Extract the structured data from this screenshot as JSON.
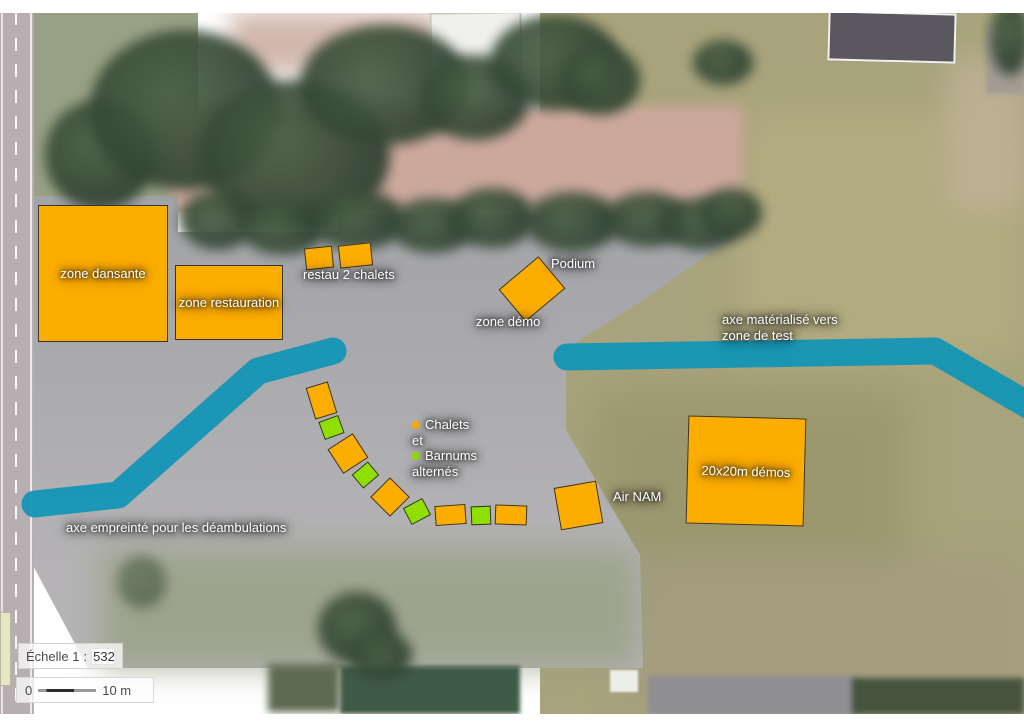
{
  "colors": {
    "chalet_orange": "#FBAD00",
    "barnum_green": "#8FE000",
    "axis_teal": "#1095B6",
    "shape_border": "#38342b"
  },
  "background": {
    "features": [
      {
        "name": "grass-field-right",
        "x": 540,
        "y": 10,
        "w": 484,
        "h": 708,
        "bg": "#a8a37c"
      },
      {
        "name": "grass-field-patch-light",
        "x": 740,
        "y": 110,
        "w": 284,
        "h": 250,
        "bg": "#b4ac82",
        "blur": 18,
        "opacity": 0.9
      },
      {
        "name": "grass-field-patch-dark",
        "x": 590,
        "y": 390,
        "w": 320,
        "h": 200,
        "bg": "#98956c",
        "blur": 22,
        "opacity": 0.8
      },
      {
        "name": "grass-field-patch-brown",
        "x": 620,
        "y": 556,
        "w": 404,
        "h": 150,
        "bg": "#a59c7e",
        "blur": 18,
        "opacity": 0.9
      },
      {
        "name": "grass-field-pink-edge",
        "x": 948,
        "y": 58,
        "w": 76,
        "h": 150,
        "bg": "#c0b298",
        "blur": 14,
        "opacity": 0.8
      },
      {
        "name": "grass-strip-left",
        "x": 28,
        "y": 12,
        "w": 170,
        "h": 200,
        "bg": "#98a185"
      },
      {
        "name": "dirt-strip-top",
        "x": 168,
        "y": 106,
        "w": 574,
        "h": 110,
        "bg": "#cca89c",
        "blur": 6
      },
      {
        "name": "dirt-patch-topcenter",
        "x": 230,
        "y": 12,
        "w": 210,
        "h": 62,
        "bg": "#c9ab9e",
        "blur": 12,
        "opacity": 0.85
      },
      {
        "name": "asphalt-lot",
        "x": 0,
        "y": 0,
        "w": 1024,
        "h": 728,
        "bg": "linear-gradient(180deg,#9b9da1 0%,#a8a8ac 45%,#b5b3b5 78%)",
        "clip": "polygon(30px 196px,178px 196px,178px 232px,338px 232px,338px 214px,726px 214px,726px 242px,643px 300px,574px 344px,566px 360px,566px 430px,640px 555px,643px 668px,88px 668px,30px 560px)"
      },
      {
        "name": "grass-regrowth-lot",
        "x": 100,
        "y": 548,
        "w": 540,
        "h": 120,
        "bg": "#98a083",
        "blur": 16,
        "opacity": 0.8
      },
      {
        "name": "road-left",
        "x": 0,
        "y": 12,
        "w": 34,
        "h": 704,
        "bg": "#b6aeb0"
      },
      {
        "name": "road-line-left-edge",
        "x": 1,
        "y": 12,
        "w": 2,
        "h": 704,
        "bg": "#f4f2f0",
        "opacity": 0.8
      },
      {
        "name": "road-line-center-dashed",
        "x": 15,
        "y": 12,
        "w": 2,
        "h": 704,
        "bg": "repeating-linear-gradient(180deg,#ffffff 0 13px,rgba(255,255,255,0) 13px 26px)",
        "opacity": 0.9
      },
      {
        "name": "road-line-right-edge",
        "x": 30,
        "y": 12,
        "w": 2,
        "h": 704,
        "bg": "#f4f2f0",
        "opacity": 0.85
      },
      {
        "name": "inset-map-sliver",
        "x": 0,
        "y": 612,
        "w": 9,
        "h": 72,
        "bg": "#e4e6c4",
        "border": "1px solid #b8b89a"
      },
      {
        "name": "building-white-roof",
        "x": 430,
        "y": 12,
        "w": 88,
        "h": 64,
        "bg": "#f0f0ec",
        "border": "2px solid #c9c9c2",
        "rot": -1
      },
      {
        "name": "building-dark-roof",
        "x": 828,
        "y": 12,
        "w": 124,
        "h": 46,
        "bg": "#5a575e",
        "border": "2px solid #f2f2ef",
        "rot": 1.5
      },
      {
        "name": "structure-right-edge",
        "x": 986,
        "y": 24,
        "w": 38,
        "h": 70,
        "bg": "#a49c93",
        "blur": 2
      },
      {
        "name": "greenhouse-bottom",
        "x": 340,
        "y": 666,
        "w": 180,
        "h": 48,
        "bg": "#3f5a46",
        "blur": 2
      },
      {
        "name": "hedge-bottom-left",
        "x": 268,
        "y": 664,
        "w": 72,
        "h": 48,
        "bg": "#5d6b52",
        "blur": 4
      },
      {
        "name": "white-shed-bottom",
        "x": 610,
        "y": 670,
        "w": 28,
        "h": 22,
        "bg": "#eceeea",
        "blur": 1
      },
      {
        "name": "shed-row-bottom",
        "x": 648,
        "y": 676,
        "w": 210,
        "h": 38,
        "bg": "#8f8e92",
        "blur": 2
      },
      {
        "name": "hedge-bottom-right",
        "x": 852,
        "y": 678,
        "w": 172,
        "h": 36,
        "bg": "#46543f",
        "blur": 3
      },
      {
        "name": "tree-canopy",
        "x": 45,
        "y": 100,
        "w": 110,
        "h": 110,
        "tree": true
      },
      {
        "name": "tree-canopy",
        "x": 90,
        "y": 30,
        "w": 190,
        "h": 160,
        "tree": true
      },
      {
        "name": "tree-canopy",
        "x": 200,
        "y": 80,
        "w": 190,
        "h": 150,
        "tree": true
      },
      {
        "name": "tree-canopy",
        "x": 300,
        "y": 25,
        "w": 170,
        "h": 120,
        "tree": true
      },
      {
        "name": "tree-canopy",
        "x": 420,
        "y": 55,
        "w": 110,
        "h": 85,
        "tree": true
      },
      {
        "name": "tree-canopy",
        "x": 490,
        "y": 15,
        "w": 130,
        "h": 95,
        "tree": true
      },
      {
        "name": "tree-canopy",
        "x": 560,
        "y": 45,
        "w": 80,
        "h": 70,
        "tree": true
      },
      {
        "name": "tree-canopy",
        "x": 180,
        "y": 190,
        "w": 75,
        "h": 60,
        "tree": true
      },
      {
        "name": "tree-canopy",
        "x": 240,
        "y": 200,
        "w": 85,
        "h": 55,
        "tree": true
      },
      {
        "name": "tree-canopy",
        "x": 310,
        "y": 190,
        "w": 95,
        "h": 60,
        "tree": true
      },
      {
        "name": "tree-canopy",
        "x": 390,
        "y": 198,
        "w": 85,
        "h": 55,
        "tree": true
      },
      {
        "name": "tree-canopy",
        "x": 450,
        "y": 188,
        "w": 85,
        "h": 60,
        "tree": true
      },
      {
        "name": "tree-canopy",
        "x": 525,
        "y": 192,
        "w": 95,
        "h": 60,
        "tree": true
      },
      {
        "name": "tree-canopy",
        "x": 605,
        "y": 192,
        "w": 85,
        "h": 55,
        "tree": true
      },
      {
        "name": "tree-canopy",
        "x": 662,
        "y": 198,
        "w": 78,
        "h": 52,
        "tree": true
      },
      {
        "name": "tree-canopy",
        "x": 700,
        "y": 188,
        "w": 62,
        "h": 50,
        "tree": true
      },
      {
        "name": "tree-canopy",
        "x": 693,
        "y": 40,
        "w": 60,
        "h": 45,
        "tree": true
      },
      {
        "name": "tree-canopy",
        "x": 990,
        "y": 0,
        "w": 40,
        "h": 75,
        "tree": true
      },
      {
        "name": "tree-canopy",
        "x": 318,
        "y": 592,
        "w": 78,
        "h": 72,
        "tree": true
      },
      {
        "name": "tree-canopy",
        "x": 350,
        "y": 630,
        "w": 62,
        "h": 50,
        "tree": true
      },
      {
        "name": "tree-canopy",
        "x": 118,
        "y": 556,
        "w": 48,
        "h": 52,
        "tree": true,
        "opacity": 0.55
      },
      {
        "name": "margin-top-white",
        "x": 0,
        "y": 0,
        "w": 1024,
        "h": 13,
        "bg": "#ffffff"
      },
      {
        "name": "margin-bottom-white",
        "x": 0,
        "y": 714,
        "w": 1024,
        "h": 14,
        "bg": "#ffffff"
      }
    ]
  },
  "paths": [
    {
      "name": "axe-deambulations-path",
      "points": "35,504 118,495 258,371 333,351"
    },
    {
      "name": "axe-zone-test-path",
      "points": "567,357 935,351 1040,412"
    }
  ],
  "zones": [
    {
      "name": "zone-dansante",
      "label": "zone dansante",
      "x": 38,
      "y": 205,
      "w": 130,
      "h": 137,
      "rot": 0
    },
    {
      "name": "zone-restauration",
      "label": "zone restauration",
      "x": 175,
      "y": 265,
      "w": 108,
      "h": 75,
      "rot": 0
    },
    {
      "name": "restau-chalet-1",
      "x": 305,
      "y": 247,
      "w": 28,
      "h": 22,
      "rot": -6
    },
    {
      "name": "restau-chalet-2",
      "x": 339,
      "y": 244,
      "w": 33,
      "h": 23,
      "rot": -6
    },
    {
      "name": "podium-stage",
      "x": 506,
      "y": 268,
      "w": 52,
      "h": 42,
      "rot": -40
    },
    {
      "name": "air-nam-square",
      "x": 557,
      "y": 484,
      "w": 43,
      "h": 43,
      "rot": -10
    },
    {
      "name": "demos-20x20-square",
      "label": "20x20m démos",
      "x": 687,
      "y": 417,
      "w": 118,
      "h": 108,
      "rot": 1.5
    }
  ],
  "arc_markers": [
    {
      "type": "chalet",
      "x": 310,
      "y": 384,
      "w": 23,
      "h": 33,
      "rot": -17
    },
    {
      "type": "barnum",
      "x": 321,
      "y": 418,
      "w": 21,
      "h": 19,
      "rot": -20
    },
    {
      "type": "chalet",
      "x": 333,
      "y": 439,
      "w": 30,
      "h": 29,
      "rot": -33
    },
    {
      "type": "barnum",
      "x": 355,
      "y": 466,
      "w": 21,
      "h": 18,
      "rot": -40
    },
    {
      "type": "chalet",
      "x": 376,
      "y": 483,
      "w": 28,
      "h": 28,
      "rot": -45
    },
    {
      "type": "barnum",
      "x": 406,
      "y": 502,
      "w": 22,
      "h": 19,
      "rot": -28
    },
    {
      "type": "chalet",
      "x": 435,
      "y": 505,
      "w": 31,
      "h": 20,
      "rot": -4
    },
    {
      "type": "barnum",
      "x": 471,
      "y": 506,
      "w": 20,
      "h": 19,
      "rot": -2
    },
    {
      "type": "chalet",
      "x": 495,
      "y": 505,
      "w": 32,
      "h": 20,
      "rot": 2
    }
  ],
  "labels": [
    {
      "name": "label-restau-2-chalets",
      "lines": [
        "restau 2 chalets"
      ],
      "x": 303,
      "y": 267
    },
    {
      "name": "label-podium",
      "lines": [
        "Podium"
      ],
      "x": 551,
      "y": 256
    },
    {
      "name": "label-zone-demo",
      "lines": [
        "zone démo"
      ],
      "x": 476,
      "y": 314
    },
    {
      "name": "label-axe-materialise",
      "lines": [
        "axe matérialisé vers",
        "zone de test"
      ],
      "x": 722,
      "y": 312
    },
    {
      "name": "label-air-nam",
      "lines": [
        "Air NAM"
      ],
      "x": 613,
      "y": 489
    },
    {
      "name": "label-axe-empreinte",
      "lines": [
        "axe empreinté pour les déambulations"
      ],
      "x": 66,
      "y": 520
    }
  ],
  "legend": {
    "items": [
      {
        "dot": "#FBAD00",
        "text": "Chalets"
      },
      {
        "dot": null,
        "text": "et"
      },
      {
        "dot": "#8FE000",
        "text": "Barnums"
      },
      {
        "dot": null,
        "text": "alternés"
      }
    ]
  },
  "scale_widget": {
    "label": "Échelle 1",
    "colon": ":",
    "value": "532",
    "bar_zero": "0",
    "bar_label": "10 m"
  }
}
